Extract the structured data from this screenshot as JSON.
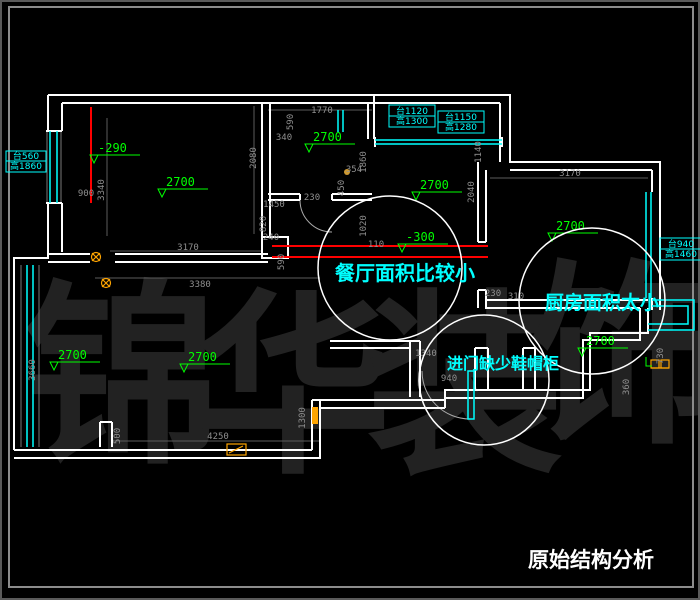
{
  "title": {
    "text": "原始结构分析"
  },
  "watermark": {
    "text": "锦华装饰",
    "chars": [
      "锦",
      "华",
      "装",
      "饰"
    ]
  },
  "annotations": [
    {
      "id": "dining",
      "text": "餐厅面积比较小"
    },
    {
      "id": "kitchen",
      "text": "厨房面积太小"
    },
    {
      "id": "entry",
      "text": "进门缺少鞋帽柜"
    }
  ],
  "elevations": [
    {
      "text": "-290"
    },
    {
      "text": "2700"
    },
    {
      "text": "2700"
    },
    {
      "text": "2700"
    },
    {
      "text": "2700"
    },
    {
      "text": "-300"
    },
    {
      "text": "2700"
    },
    {
      "text": "2700"
    },
    {
      "text": "2700"
    }
  ],
  "window_specs": [
    {
      "line1": "台560",
      "line2": "高1860"
    },
    {
      "line1": "台1120",
      "line2": "高1300"
    },
    {
      "line1": "台1150",
      "line2": "高1280"
    },
    {
      "line1": "台940",
      "line2": "高1460"
    }
  ],
  "dimensions": [
    {
      "text": "900"
    },
    {
      "text": "3340"
    },
    {
      "text": "2080"
    },
    {
      "text": "3170"
    },
    {
      "text": "3380"
    },
    {
      "text": "1770"
    },
    {
      "text": "590"
    },
    {
      "text": "340"
    },
    {
      "text": "1860"
    },
    {
      "text": "354"
    },
    {
      "text": "450"
    },
    {
      "text": "230"
    },
    {
      "text": "1450"
    },
    {
      "text": "820"
    },
    {
      "text": "1020"
    },
    {
      "text": "110"
    },
    {
      "text": "240"
    },
    {
      "text": "590"
    },
    {
      "text": "1140"
    },
    {
      "text": "2040"
    },
    {
      "text": "3170"
    },
    {
      "text": "730"
    },
    {
      "text": "230"
    },
    {
      "text": "310"
    },
    {
      "text": "360"
    },
    {
      "text": "940"
    },
    {
      "text": "1340"
    },
    {
      "text": "3660"
    },
    {
      "text": "500"
    },
    {
      "text": "1300"
    },
    {
      "text": "4250"
    }
  ],
  "colors": {
    "background": "#000000",
    "wall": "#ffffff",
    "window": "#00ffff",
    "elevation": "#00ff00",
    "dimension": "#8f8f8f",
    "highlight_line": "#ff0000",
    "symbol": "#ffa500",
    "annotation": "#00ffff",
    "watermark": "#222222",
    "frame": "#8c8c8c"
  }
}
